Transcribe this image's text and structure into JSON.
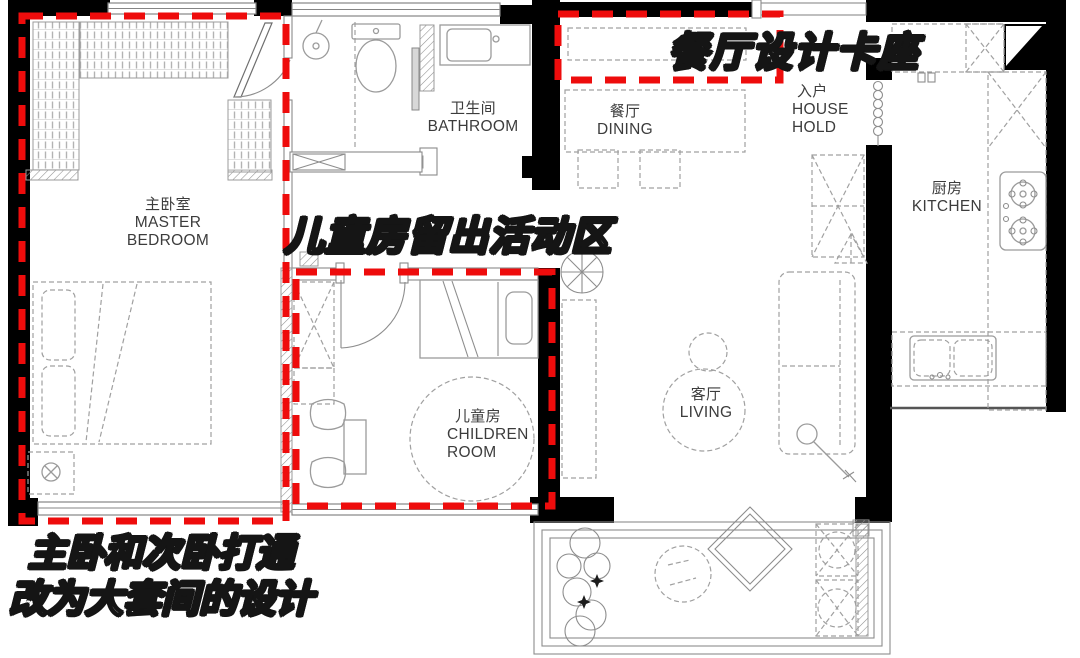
{
  "document": {
    "kind": "apartment floor plan with renovation notes",
    "background": "#ffffff"
  },
  "colors": {
    "wall": "#000000",
    "furniture_line": "#9b9b9b",
    "label_text": "#3c3c3c",
    "highlight_dash": "#ee0c0c",
    "annotation_fill": "#ffffff",
    "annotation_outline": "#151515"
  },
  "rooms": {
    "master_bedroom": {
      "zh": "主卧室",
      "en": "MASTER BEDROOM"
    },
    "bathroom": {
      "zh": "卫生间",
      "en": "BATHROOM"
    },
    "dining": {
      "zh": "餐厅",
      "en": "DINING"
    },
    "entry": {
      "zh": "入户",
      "en": "HOUSE HOLD"
    },
    "kitchen": {
      "zh": "厨房",
      "en": "KITCHEN"
    },
    "children_room": {
      "zh": "儿童房",
      "en": "CHILDREN ROOM"
    },
    "living_room": {
      "zh": "客厅",
      "en": "LIVING"
    }
  },
  "annotations": {
    "dining_booth": {
      "text": "餐厅设计卡座"
    },
    "children_activity": {
      "text": "儿童房留出活动区"
    },
    "master_suite": {
      "line1": "主卧和次卧打通",
      "line2": "改为大套间的设计"
    }
  },
  "highlights": {
    "color": "#ee0c0c",
    "style": "dashed-rectangle",
    "regions": [
      "master-suite",
      "children-room",
      "dining-booth"
    ]
  }
}
